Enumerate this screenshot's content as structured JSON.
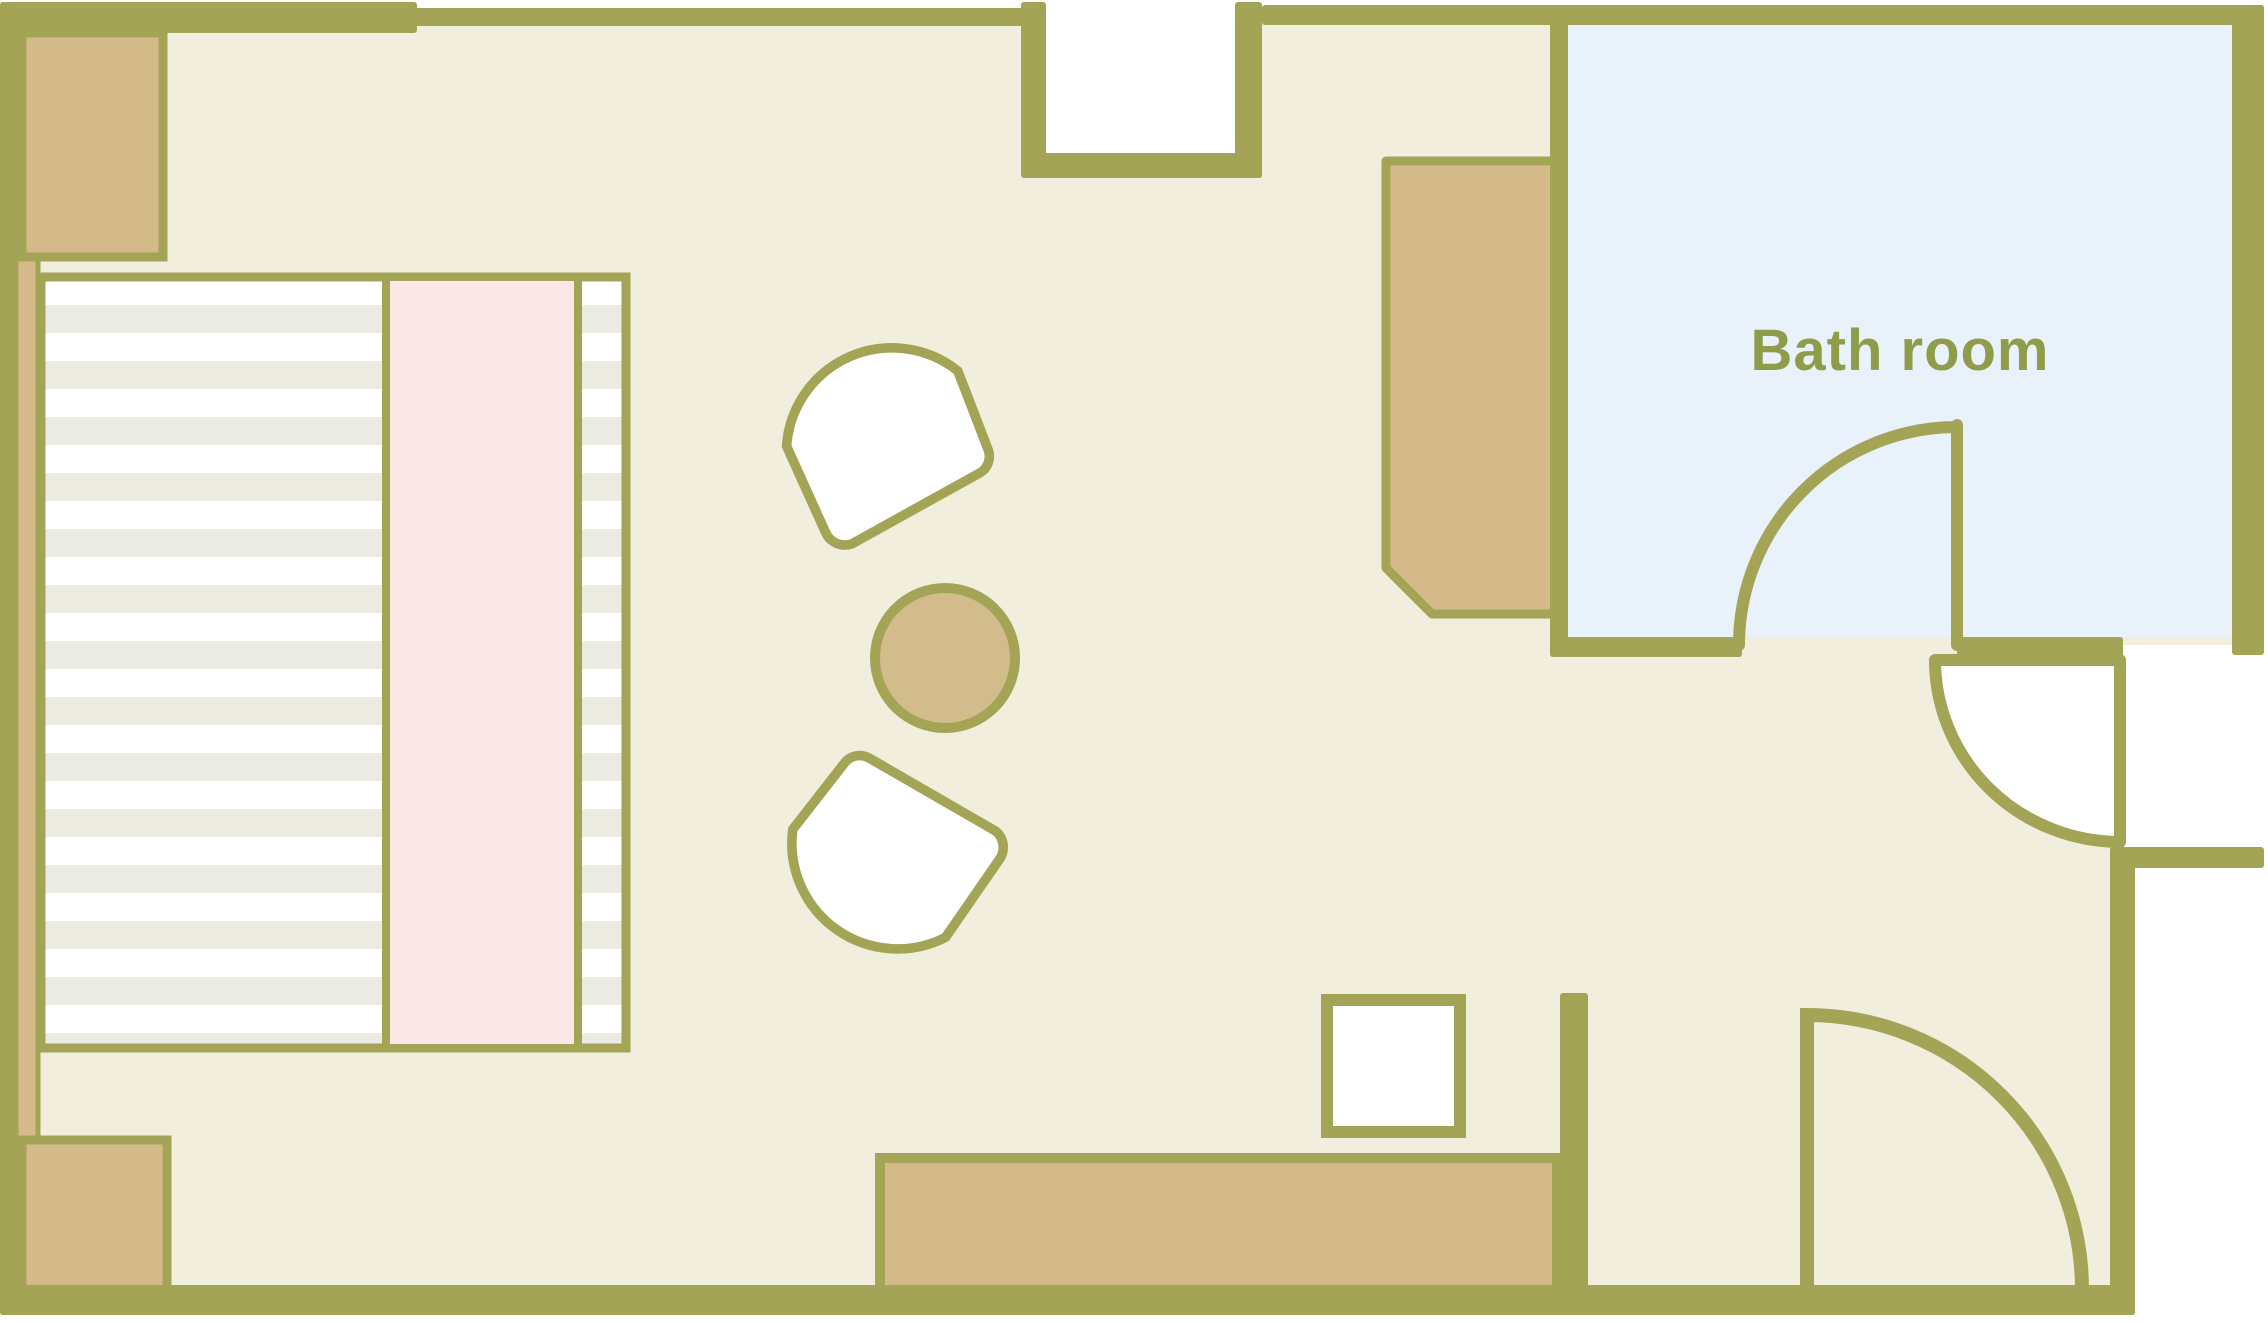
{
  "labels": {
    "bathroom": "Bath room"
  },
  "palette": {
    "wall_olive": "#a4a457",
    "floor_cream": "#f1eedd",
    "bathroom_floor_blue": "#e9f1fa",
    "furniture_tan": "#d3ba88",
    "bed_stripe_gray": "#ebebe1",
    "bed_runner_pink": "#fae7e6",
    "furniture_white": "#ffffff",
    "label_text_olive": "#8f9c4a"
  },
  "rooms": {
    "bathroom_label": "Bath room"
  }
}
